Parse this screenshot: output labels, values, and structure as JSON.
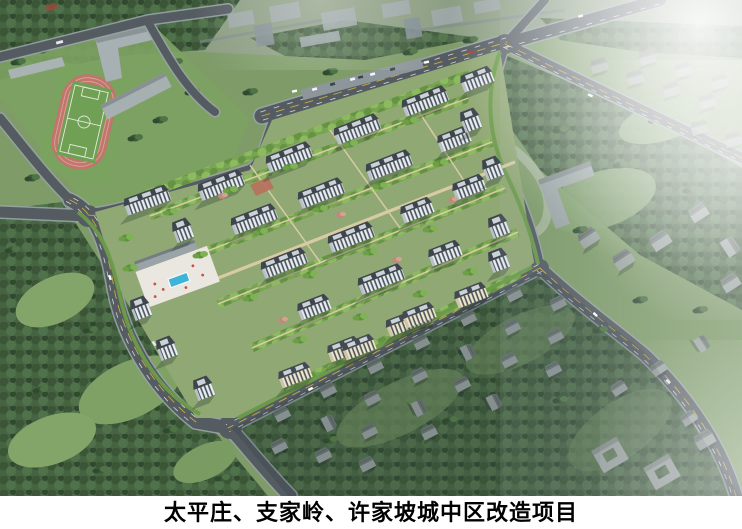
{
  "caption": {
    "title": "太平庄、支家岭、许家坡城中区改造项目"
  },
  "scene": {
    "type": "aerial-architectural-rendering",
    "landmarks": [
      "soccer-field-with-running-track",
      "school-buildings",
      "residential-compound",
      "swimming-pool-plaza",
      "village-houses",
      "city-blocks",
      "road-network",
      "haze-top-right"
    ]
  },
  "palette": {
    "grass": "#7e9b68",
    "forest": "#466342",
    "road": "#545c62",
    "sidewalk": "#99a3a7",
    "track_red": "#c1766b",
    "field_green": "#6fa054",
    "pool_blue": "#3fb4d8",
    "building_white": "#e9edf0",
    "building_cream": "#efe7cd",
    "roof_dark": "#3e454d",
    "village_gray": "#9aa3a0",
    "path_tan": "#dbcda9",
    "caption_bg": "#ffffff",
    "caption_text": "#000000"
  }
}
